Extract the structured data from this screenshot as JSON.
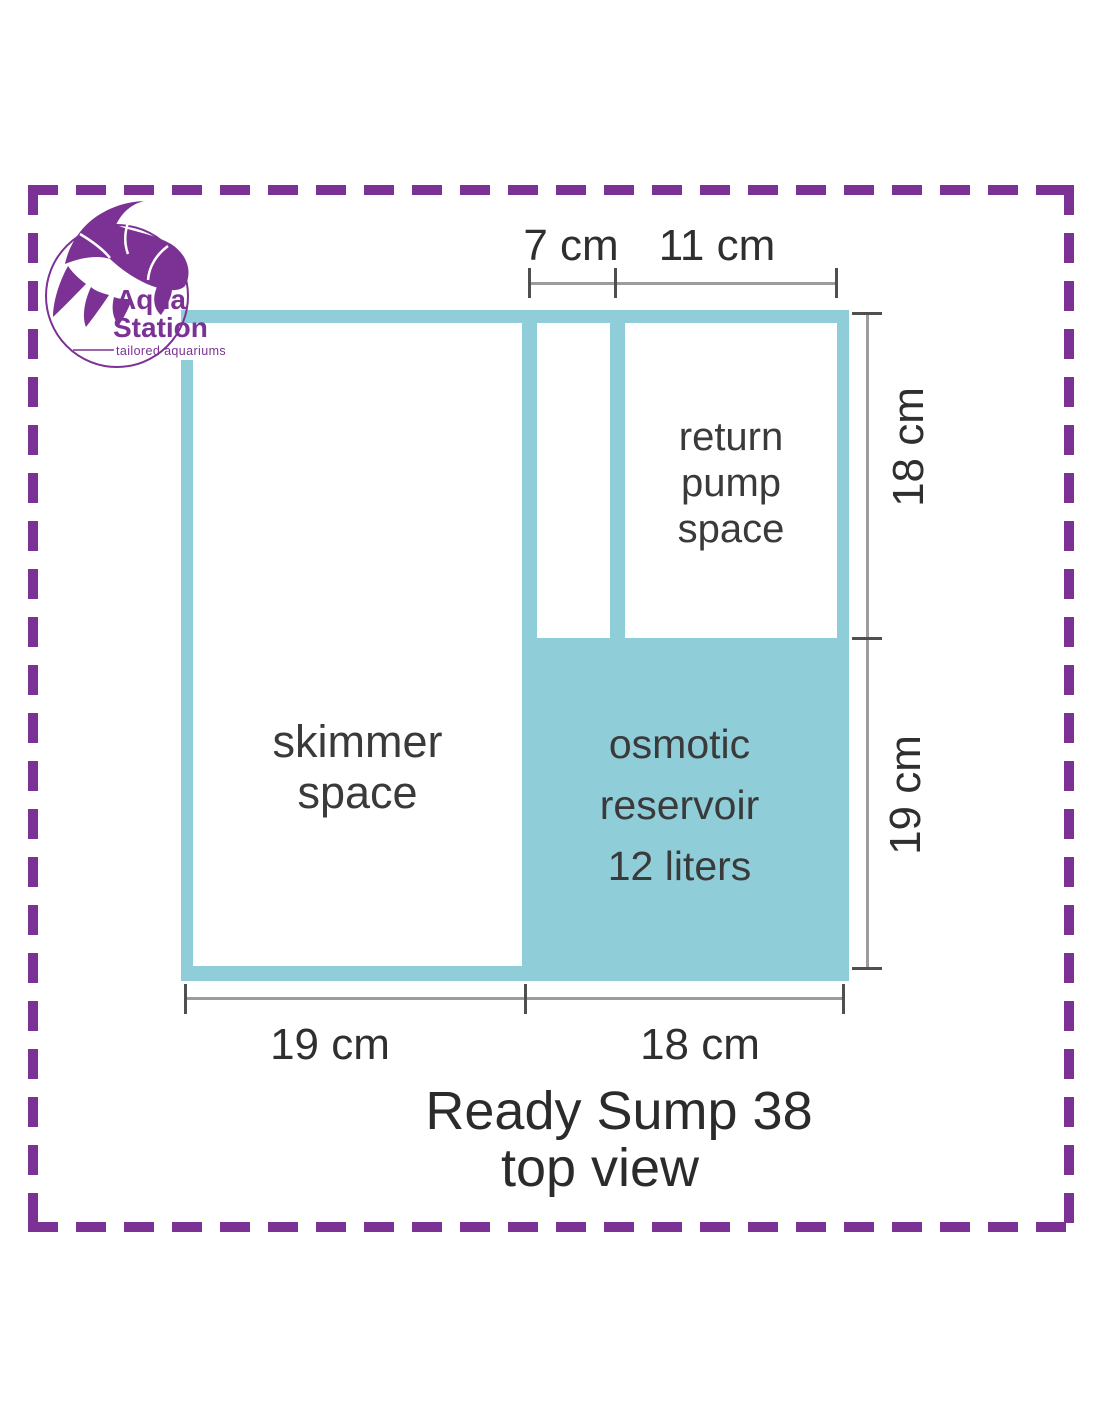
{
  "logo": {
    "brand_top": "Aqua",
    "brand_bottom": "Station",
    "tagline": "tailored aquariums"
  },
  "diagram": {
    "compartments": {
      "skimmer": {
        "line1": "skimmer",
        "line2": "space"
      },
      "return_pump": {
        "line1": "return",
        "line2": "pump",
        "line3": "space"
      },
      "osmotic_reservoir": {
        "line1": "osmotic",
        "line2": "reservoir",
        "line3": "12 liters"
      }
    },
    "dimensions": {
      "top_inner": "7 cm",
      "top_outer": "11 cm",
      "right_upper": "18 cm",
      "right_lower": "19 cm",
      "bottom_left": "19 cm",
      "bottom_right": "18 cm"
    },
    "caption": {
      "line1": "Ready Sump 38",
      "line2": "top view"
    }
  },
  "colors": {
    "teal": "#8FCDD9",
    "brand_purple": "#7B3294",
    "dimension_line": "#9C9C9C",
    "tick": "#4F4F4F",
    "label_text": "#2F2F2F"
  }
}
